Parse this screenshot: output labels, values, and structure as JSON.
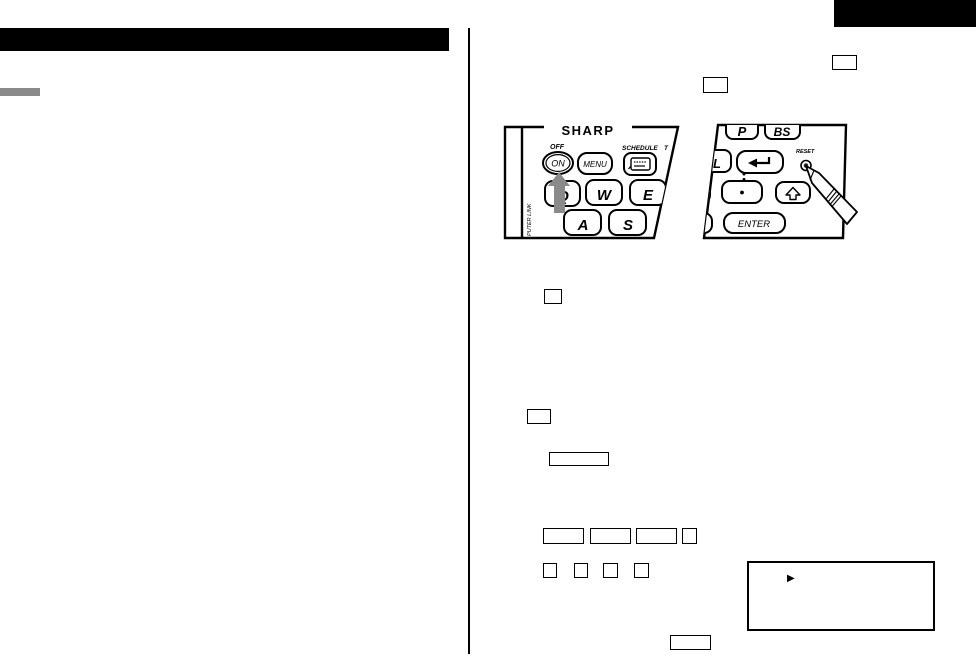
{
  "page": {
    "background_color": "#ffffff",
    "ink_color": "#000000",
    "accent_gray": "#8a8a8a",
    "note": ""
  },
  "left_keyboard": {
    "brand": "SHARP",
    "labels": {
      "off": "OFF",
      "schedule": "SCHEDULE",
      "schedule_next_partial": "T",
      "side_vertical": "PUTER LINK"
    },
    "keys": {
      "on": "ON",
      "menu": "MENU",
      "q": "Q",
      "w": "W",
      "e": "E",
      "a": "A",
      "s": "S"
    }
  },
  "right_keyboard": {
    "labels": {
      "reset": "RESET"
    },
    "keys": {
      "p": "P",
      "bs": "BS",
      "l": "L",
      "enter": "ENTER"
    }
  },
  "callout": {
    "bullet": "▶"
  }
}
